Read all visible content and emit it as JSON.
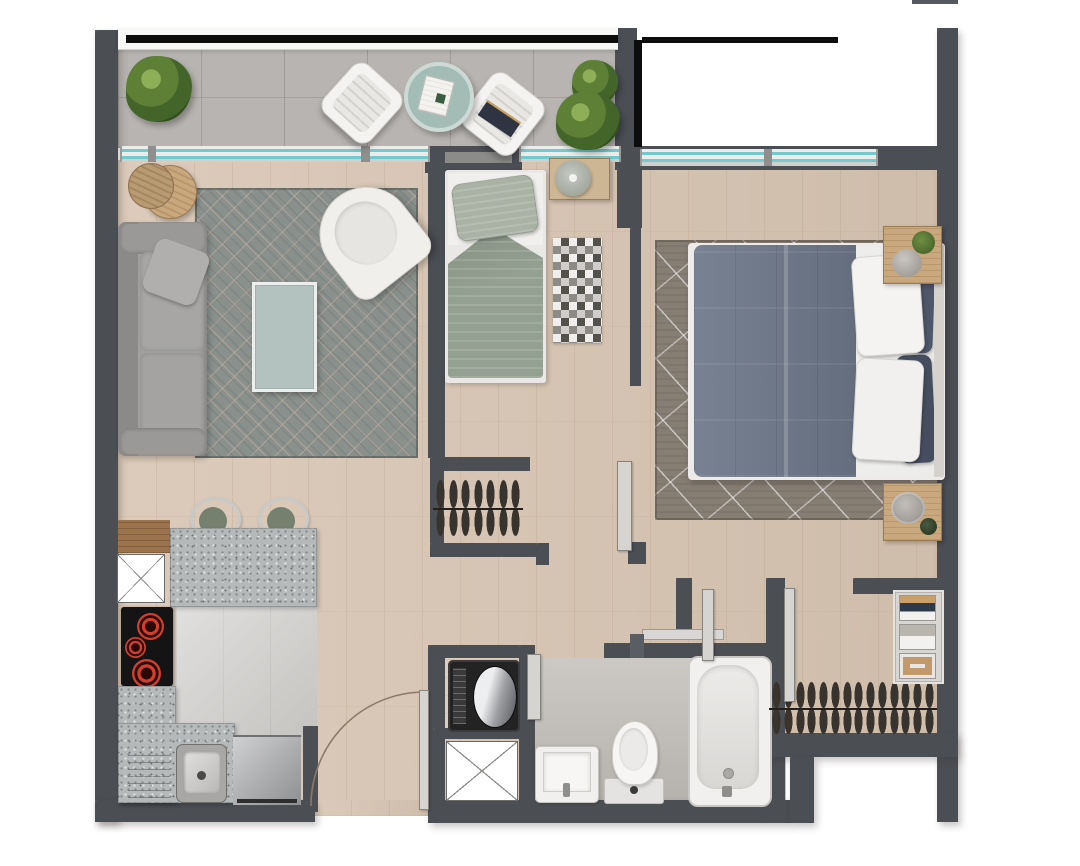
{
  "palette": {
    "wall": "#4b4e53",
    "wood": "#d8c5b3",
    "balcony_tile": "#b7b4b1",
    "kitchen_tile": "#d0cecb",
    "bath_tile": "#c4c0bc",
    "window_glass": "#74c9cd",
    "window_frame": "#ececea",
    "rug_living": "#8a918d",
    "rug_master": "#867d73",
    "granite": "#b6b9ba",
    "sofa": "#a09f9d",
    "armchair": "#f0efec",
    "bed_small_duvet": "#94a091",
    "bed_master_duvet": "#6d7789",
    "pillow_navy": "#4e5669",
    "wood_furniture": "#c9a87e",
    "stool_seat": "#76806f",
    "cooktop_burner": "#d2402c",
    "appliance_steel": "#b9babc",
    "railing_black": "#0d0d0d",
    "door_panel": "#d5d4d1",
    "plant_green": "#5d7f36",
    "table_teal": "#a3bcb6",
    "white_fixture": "#f1f0ee"
  },
  "rooms": {
    "balcony": {
      "items": [
        "potted-plant",
        "lounge-chair",
        "round-table",
        "lounge-chair",
        "potted-plant"
      ],
      "plant_count": 2,
      "chair_count": 2
    },
    "living": {
      "items": [
        "sofa",
        "throw-pillow",
        "area-rug",
        "glass-coffee-table",
        "tub-armchair",
        "round-side-table"
      ]
    },
    "kitchen": {
      "items": [
        "breakfast-bar",
        "bar-stool",
        "bar-stool",
        "service-shaft",
        "induction-cooktop",
        "l-counter",
        "sink",
        "dishwasher"
      ],
      "stool_count": 2,
      "burner_count": 3
    },
    "bedroom_small": {
      "items": [
        "single-bed",
        "pillow",
        "nightstand",
        "table-lamp",
        "checkered-rug"
      ]
    },
    "bedroom_master": {
      "items": [
        "double-bed",
        "white-pillows",
        "navy-pillows",
        "area-rug",
        "nightstand-plant",
        "nightstand-pouf"
      ]
    },
    "hallway": {
      "items": [
        "coat-closet",
        "entry-door",
        "sliding-door"
      ],
      "closet_hanger_count": 7
    },
    "laundry": {
      "items": [
        "washing-machine",
        "service-shaft"
      ]
    },
    "bathroom": {
      "items": [
        "washbasin",
        "toilet",
        "bathtub",
        "towel-bar",
        "sliding-door"
      ]
    },
    "walkin_closet": {
      "items": [
        "hanging-rail",
        "shelf-unit",
        "sliding-door",
        "sliding-door"
      ],
      "hanger_count": 14,
      "shelf_count": 3
    }
  }
}
